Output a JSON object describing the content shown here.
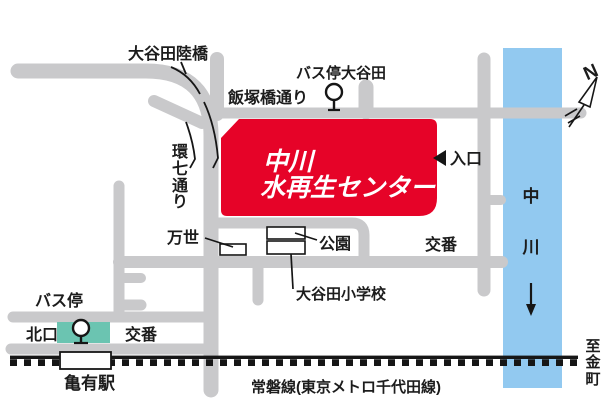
{
  "facility": {
    "line1": "中川",
    "line2": "水再生センター"
  },
  "labels": {
    "oyata_rikkyo": "大谷田陸橋",
    "kannana_dori": "環七通り",
    "iizuka_dori": "飯塚橋通り",
    "bus_stop_oyata": "バス停大谷田",
    "entrance": "入口",
    "mansei": "万世",
    "park": "公園",
    "police_upper": "交番",
    "elementary_school": "大谷田小学校",
    "bus_stop": "バス停",
    "north_exit": "北口",
    "police_lower": "交番",
    "kameari_station": "亀有駅",
    "joban_line": "常磐線(東京メトロ千代田線)",
    "river": "中川",
    "to_kanamachi": "至金町",
    "north": "N"
  },
  "colors": {
    "road": "#c9c9cb",
    "facility_red": "#e60328",
    "river_blue": "#92c9f0",
    "terminal_teal": "#6bc4b1",
    "rail": "#161616",
    "ink": "#1c1c1c"
  }
}
